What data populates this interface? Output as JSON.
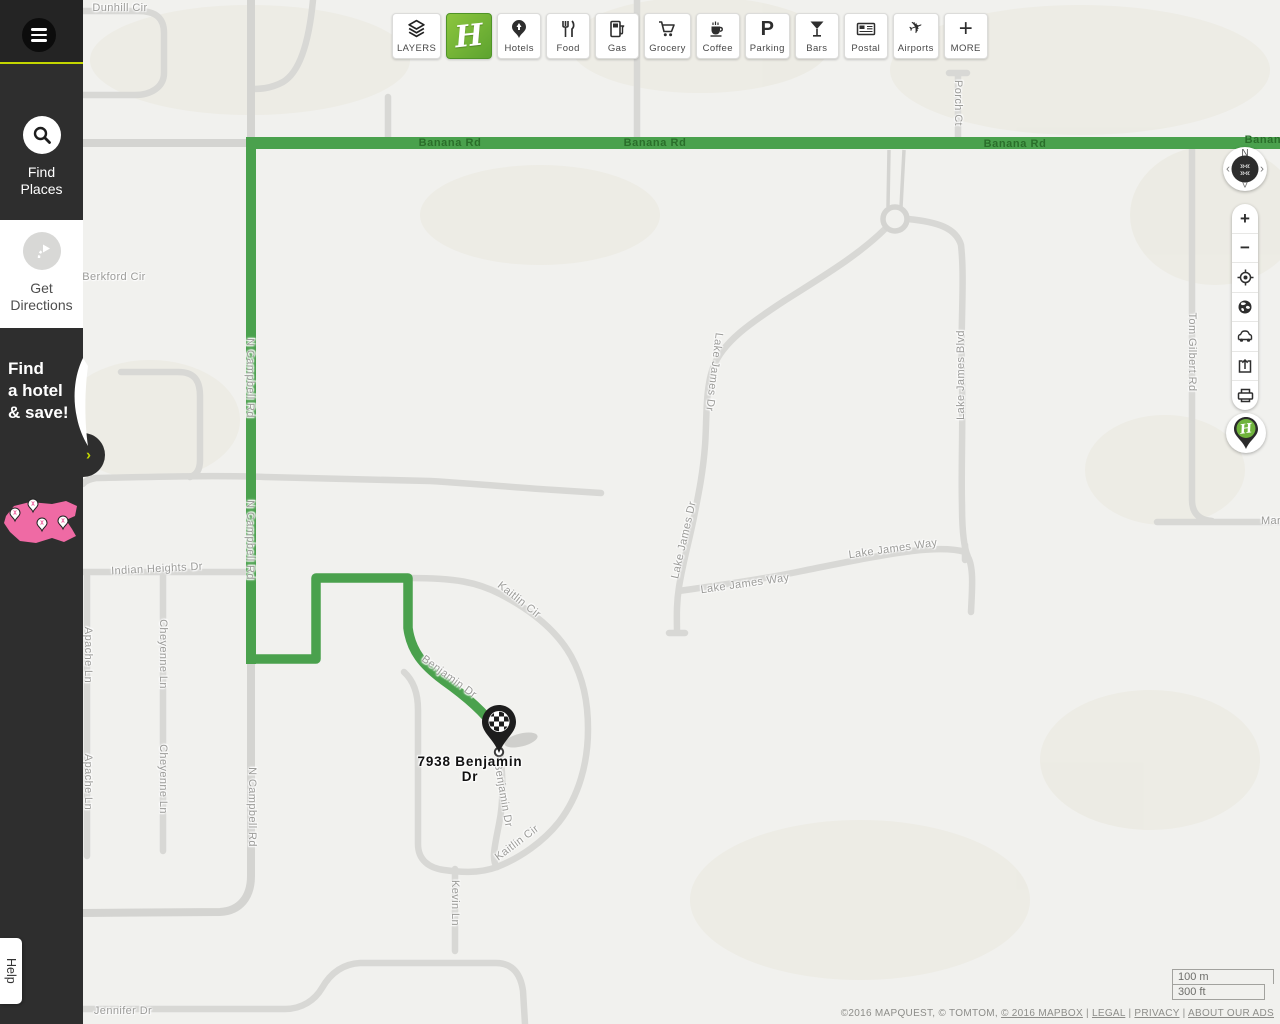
{
  "sidebar": {
    "find_places_label": "Find Places",
    "get_directions_label": "Get Directions",
    "promo": {
      "line1": "Find",
      "line2": "a hotel",
      "line3": "& save!"
    },
    "help_label": "Help"
  },
  "toolbar": {
    "layers_label": "LAYERS",
    "brand_letter": "H",
    "categories": [
      "Hotels",
      "Food",
      "Gas",
      "Grocery",
      "Coffee",
      "Parking",
      "Bars",
      "Postal",
      "Airports"
    ],
    "parking_glyph": "P",
    "more_glyph": "+",
    "more_label": "MORE"
  },
  "map_controls": {
    "compass_north": "N",
    "pan_left": "‹",
    "pan_right": "›",
    "pan_down": "˅",
    "zoom_in": "+",
    "zoom_out": "−"
  },
  "map": {
    "destination_label": "7938 Benjamin Dr",
    "road_labels": [
      {
        "t": "Dunhill Cir",
        "x": 120,
        "y": 8,
        "r": 0,
        "cls": ""
      },
      {
        "t": "Berkford Cir",
        "x": 114,
        "y": 277,
        "r": 0,
        "cls": ""
      },
      {
        "t": "N Campbell Rd",
        "x": 250,
        "y": 378,
        "r": 90,
        "cls": ""
      },
      {
        "t": "N Campbell Rd",
        "x": 250,
        "y": 540,
        "r": 90,
        "cls": ""
      },
      {
        "t": "N Campbell Rd",
        "x": 252,
        "y": 807,
        "r": 90,
        "cls": ""
      },
      {
        "t": "Banana Rd",
        "x": 450,
        "y": 143,
        "r": 0,
        "cls": "g"
      },
      {
        "t": "Banana Rd",
        "x": 655,
        "y": 143,
        "r": 0,
        "cls": "g"
      },
      {
        "t": "Banana Rd",
        "x": 1015,
        "y": 144,
        "r": 0,
        "cls": "g"
      },
      {
        "t": "Banana Rd",
        "x": 1276,
        "y": 140,
        "r": 0,
        "cls": "g"
      },
      {
        "t": "Porch Ct",
        "x": 958,
        "y": 103,
        "r": 90,
        "cls": ""
      },
      {
        "t": "Tom Gilbert Rd",
        "x": 1192,
        "y": 352,
        "r": 90,
        "cls": ""
      },
      {
        "t": "Lake James Dr",
        "x": 714,
        "y": 372,
        "r": 97,
        "cls": ""
      },
      {
        "t": "Lake James Dr",
        "x": 684,
        "y": 540,
        "r": -77,
        "cls": ""
      },
      {
        "t": "Lake James Way",
        "x": 745,
        "y": 584,
        "r": -8,
        "cls": ""
      },
      {
        "t": "Lake James Way",
        "x": 893,
        "y": 549,
        "r": -8,
        "cls": ""
      },
      {
        "t": "Lake James Blvd",
        "x": 961,
        "y": 375,
        "r": -90,
        "cls": ""
      },
      {
        "t": "Marc",
        "x": 1274,
        "y": 521,
        "r": 0,
        "cls": ""
      },
      {
        "t": "Indian Heights Dr",
        "x": 157,
        "y": 569,
        "r": -3,
        "cls": ""
      },
      {
        "t": "Cheyenne Ln",
        "x": 163,
        "y": 654,
        "r": 90,
        "cls": ""
      },
      {
        "t": "Cheyenne Ln",
        "x": 163,
        "y": 779,
        "r": 90,
        "cls": ""
      },
      {
        "t": "Apache Ln",
        "x": 88,
        "y": 655,
        "r": 90,
        "cls": ""
      },
      {
        "t": "Apache Ln",
        "x": 88,
        "y": 782,
        "r": 90,
        "cls": ""
      },
      {
        "t": "Kaitlin Cir",
        "x": 519,
        "y": 600,
        "r": 38,
        "cls": ""
      },
      {
        "t": "Kaitlin Cir",
        "x": 517,
        "y": 843,
        "r": -37,
        "cls": ""
      },
      {
        "t": "Benjamin Dr",
        "x": 449,
        "y": 677,
        "r": 36,
        "cls": ""
      },
      {
        "t": "Benjamin Dr",
        "x": 503,
        "y": 795,
        "r": 80,
        "cls": ""
      },
      {
        "t": "Kevin Ln",
        "x": 455,
        "y": 903,
        "r": 90,
        "cls": ""
      },
      {
        "t": "Jennifer Dr",
        "x": 123,
        "y": 1011,
        "r": 0,
        "cls": ""
      }
    ],
    "scale": {
      "metric": "100 m",
      "imperial": "300 ft"
    },
    "attribution": {
      "prefix": "©2016 MAPQUEST, © TOMTOM, ",
      "mapbox_link": "© 2016 MAPBOX",
      "sep": " | ",
      "links": [
        "LEGAL",
        "PRIVACY",
        "ABOUT OUR ADS"
      ]
    }
  },
  "colors": {
    "accent": "#c3d600",
    "route_green": "#4aa14d",
    "brand_green": "#6fb33c",
    "road_gray": "#d8d8d5"
  }
}
